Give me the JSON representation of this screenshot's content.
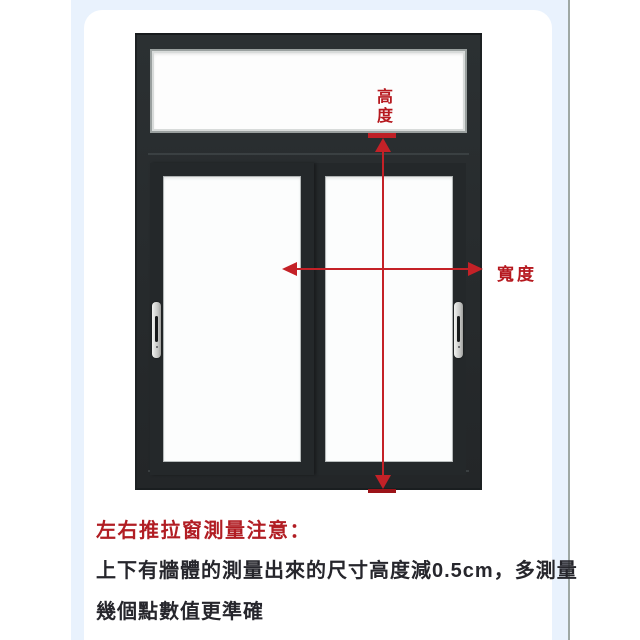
{
  "page": {
    "background_color": "#ffffff",
    "band_color": "#e9f2fd",
    "card_color": "#ffffff",
    "divider_color": "#9fa8a4"
  },
  "diagram": {
    "type": "sliding-window-measurement-illustration",
    "frame_color": "#272c2e",
    "glass_color": "#fdfdfd",
    "accent_red": "#c42127",
    "handle_color": "#c9cac8",
    "height_label": "高度",
    "width_label": "寬度"
  },
  "notes": {
    "heading": "左右推拉窗測量注意：",
    "line1": "上下有牆體的測量出來的尺寸高度減0.5cm，多測量",
    "line2": "幾個點數值更準確"
  }
}
